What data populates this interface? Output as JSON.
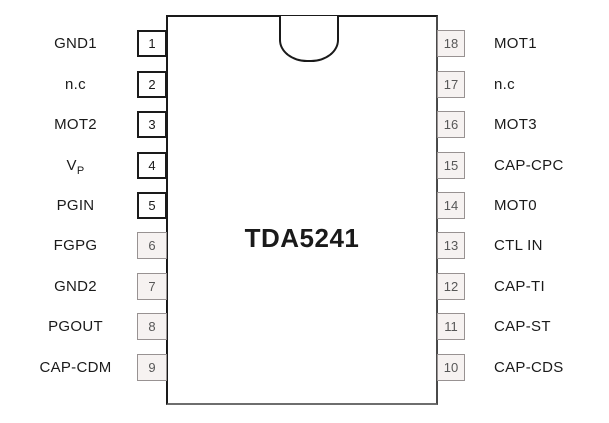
{
  "chip": {
    "label": "TDA5241"
  },
  "pins": {
    "left": [
      {
        "num": "1",
        "label": "GND1"
      },
      {
        "num": "2",
        "label": "n.c"
      },
      {
        "num": "3",
        "label": "MOT2"
      },
      {
        "num": "4",
        "label": "V",
        "label_sub": "P"
      },
      {
        "num": "5",
        "label": "PGIN"
      },
      {
        "num": "6",
        "label": "FGPG"
      },
      {
        "num": "7",
        "label": "GND2"
      },
      {
        "num": "8",
        "label": "PGOUT"
      },
      {
        "num": "9",
        "label": "CAP-CDM"
      }
    ],
    "right": [
      {
        "num": "18",
        "label": "MOT1"
      },
      {
        "num": "17",
        "label": "n.c"
      },
      {
        "num": "16",
        "label": "MOT3"
      },
      {
        "num": "15",
        "label": "CAP-CPC"
      },
      {
        "num": "14",
        "label": "MOT0"
      },
      {
        "num": "13",
        "label": "CTL IN"
      },
      {
        "num": "12",
        "label": "CAP-TI"
      },
      {
        "num": "11",
        "label": "CAP-ST"
      },
      {
        "num": "10",
        "label": "CAP-CDS"
      }
    ]
  },
  "colors": {
    "background": "#ffffff",
    "chip_border": "#1a1a1a",
    "pin_dark_border": "#1a1a1a",
    "pin_dark_fill": "#ffffff",
    "pin_light_border": "#989292",
    "pin_light_fill": "#f6f2f1",
    "pin_light_text": "#575757",
    "text": "#1a1a1a"
  }
}
